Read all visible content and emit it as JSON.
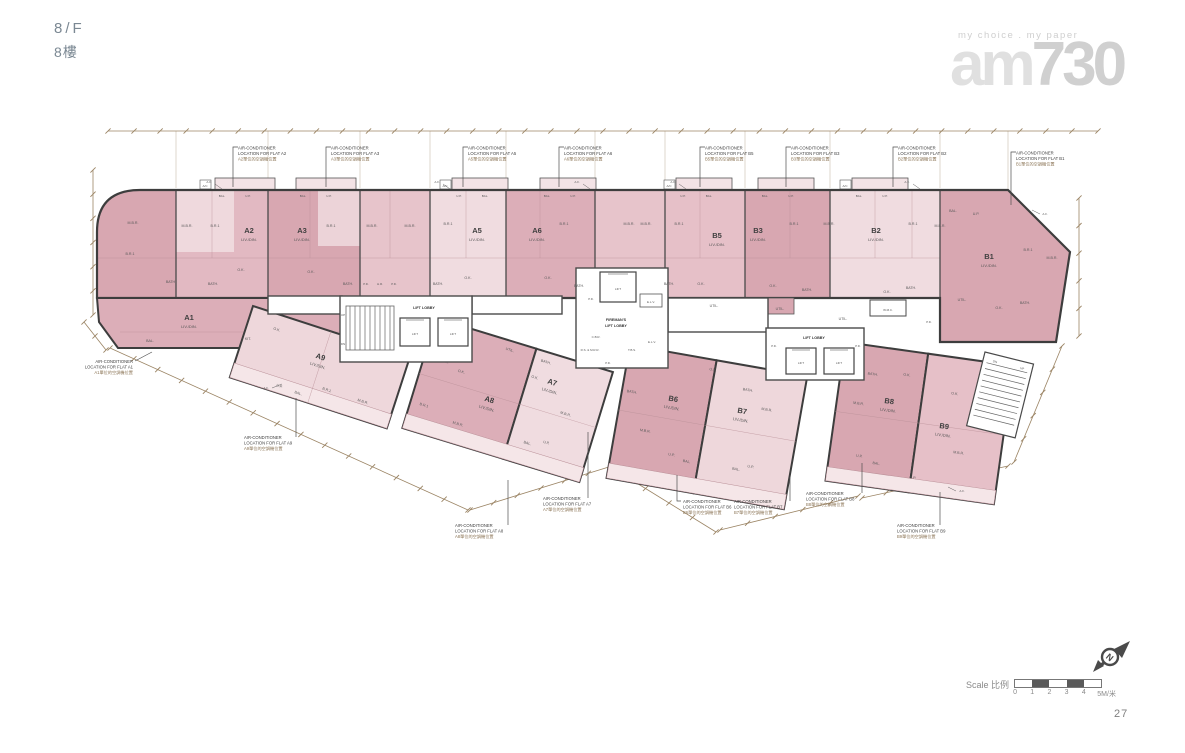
{
  "header": {
    "floor_en": "8/F",
    "floor_zh": "8樓"
  },
  "logo": {
    "tagline": "my choice . my paper",
    "name_am": "am",
    "name_730": "730"
  },
  "rooms": {
    "livdin": "LIV./DIN.",
    "mbr": "M.B.R.",
    "br1": "B.R.1",
    "bath": "BATH.",
    "ok": "O.K.",
    "kit": "KIT.",
    "util": "UTIL.",
    "bal": "BAL.",
    "up": "U.P.",
    "ac": "A/C",
    "pd": "P.D.",
    "hr": "H.R.",
    "elv": "E.L.V.",
    "cbr": "C.B.R.",
    "rsmrr": "R.S. & M.R.R.",
    "tbs": "T.B.S.",
    "lift": "LIFT",
    "lift_lobby": "LIFT LOBBY",
    "firemans": "FIREMAN'S",
    "wmc": "W.M.C.",
    "af": "A.F.",
    "up_stair": "UP",
    "dn_stair": "DN"
  },
  "flats": [
    {
      "label": "A2",
      "sub": "LIV./DIN."
    },
    {
      "label": "A3",
      "sub": "LIV./DIN."
    },
    {
      "label": "A5",
      "sub": "LIV./DIN."
    },
    {
      "label": "A6",
      "sub": "LIV./DIN."
    },
    {
      "label": "B5",
      "sub": "LIV./DIN."
    },
    {
      "label": "B3",
      "sub": "LIV./DIN."
    },
    {
      "label": "B2",
      "sub": "LIV./DIN."
    },
    {
      "label": "B1",
      "sub": "LIV./DIN."
    },
    {
      "label": "A1",
      "sub": "LIV./DIN."
    },
    {
      "label": "A9",
      "sub": "LIV./DIN."
    },
    {
      "label": "A8",
      "sub": "LIV./DIN."
    },
    {
      "label": "A7",
      "sub": "LIV./DIN."
    },
    {
      "label": "B6",
      "sub": "LIV./DIN."
    },
    {
      "label": "B7",
      "sub": "LIV./DIN."
    },
    {
      "label": "B8",
      "sub": "LIV./DIN."
    },
    {
      "label": "B9",
      "sub": "LIV./DIN."
    }
  ],
  "callouts": [
    {
      "en1": "AIR-CONDITIONER",
      "en2": "LOCATION FOR FLAT A2",
      "zh": "A2單位的空調機位置"
    },
    {
      "en1": "AIR-CONDITIONER",
      "en2": "LOCATION FOR FLAT A3",
      "zh": "A3單位的空調機位置"
    },
    {
      "en1": "AIR-CONDITIONER",
      "en2": "LOCATION FOR FLAT A5",
      "zh": "A5單位的空調機位置"
    },
    {
      "en1": "AIR-CONDITIONER",
      "en2": "LOCATION FOR FLAT A6",
      "zh": "A6單位的空調機位置"
    },
    {
      "en1": "AIR-CONDITIONER",
      "en2": "LOCATION FOR FLAT B5",
      "zh": "B5單位的空調機位置"
    },
    {
      "en1": "AIR-CONDITIONER",
      "en2": "LOCATION FOR FLAT B3",
      "zh": "B3單位的空調機位置"
    },
    {
      "en1": "AIR-CONDITIONER",
      "en2": "LOCATION FOR FLAT B2",
      "zh": "B2單位的空調機位置"
    },
    {
      "en1": "AIR-CONDITIONER",
      "en2": "LOCATION FOR FLAT B1",
      "zh": "B1單位的空調機位置"
    },
    {
      "en1": "AIR-CONDITIONER",
      "en2": "LOCATION FOR FLAT A1",
      "zh": "A1單位的空調機位置"
    },
    {
      "en1": "AIR-CONDITIONER",
      "en2": "LOCATION FOR FLAT A9",
      "zh": "A9單位的空調機位置"
    },
    {
      "en1": "AIR-CONDITIONER",
      "en2": "LOCATION FOR FLAT A8",
      "zh": "A8單位的空調機位置"
    },
    {
      "en1": "AIR-CONDITIONER",
      "en2": "LOCATION FOR FLAT A7",
      "zh": "A7單位的空調機位置"
    },
    {
      "en1": "AIR-CONDITIONER",
      "en2": "LOCATION FOR FLAT B6",
      "zh": "B6單位的空調機位置"
    },
    {
      "en1": "AIR-CONDITIONER",
      "en2": "LOCATION FOR FLAT B7",
      "zh": "B7單位的空調機位置"
    },
    {
      "en1": "AIR-CONDITIONER",
      "en2": "LOCATION FOR FLAT B8",
      "zh": "B8單位的空調機位置"
    },
    {
      "en1": "AIR-CONDITIONER",
      "en2": "LOCATION FOR FLAT B9",
      "zh": "B9單位的空調機位置"
    }
  ],
  "footer": {
    "scale_label": "Scale 比例",
    "ticks": [
      "0",
      "1",
      "2",
      "3",
      "4",
      "5M/米"
    ],
    "page": "27"
  }
}
